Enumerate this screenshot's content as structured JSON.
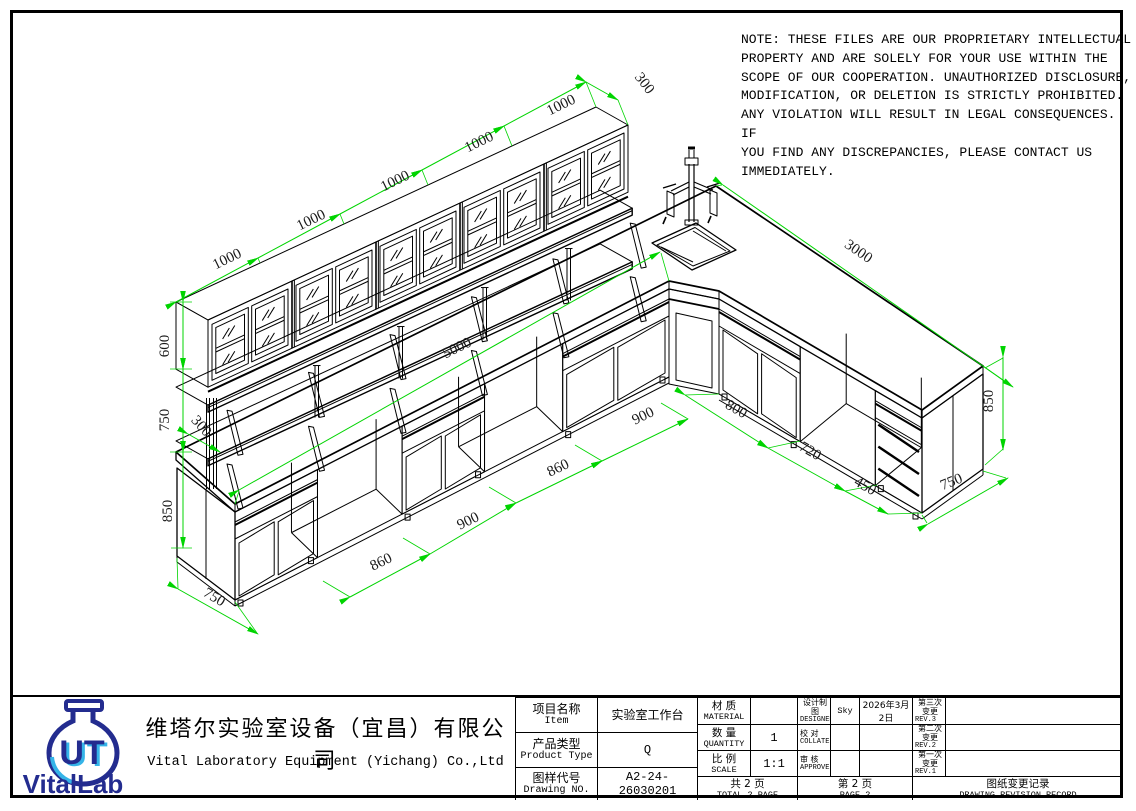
{
  "note": {
    "text": "NOTE: THESE FILES ARE OUR PROPRIETARY INTELLECTUAL\nPROPERTY AND ARE SOLELY FOR YOUR USE WITHIN THE\nSCOPE OF OUR COOPERATION. UNAUTHORIZED DISCLOSURE,\nMODIFICATION, OR DELETION IS STRICTLY PROHIBITED.\nANY VIOLATION WILL RESULT IN LEGAL CONSEQUENCES. IF\nYOU FIND ANY DISCREPANCIES, PLEASE CONTACT US\nIMMEDIATELY."
  },
  "drawing": {
    "dimension_color": "#00d400",
    "line_color": "#000000",
    "labels": [
      {
        "text": "1000",
        "x": 229,
        "y": 263,
        "r": -26
      },
      {
        "text": "1000",
        "x": 313,
        "y": 224,
        "r": -26
      },
      {
        "text": "1000",
        "x": 397,
        "y": 185,
        "r": -26
      },
      {
        "text": "1000",
        "x": 481,
        "y": 146,
        "r": -26
      },
      {
        "text": "1000",
        "x": 563,
        "y": 109,
        "r": -26
      },
      {
        "text": "300",
        "x": 641,
        "y": 86,
        "r": 52
      },
      {
        "text": "600",
        "x": 169,
        "y": 346,
        "r": -90
      },
      {
        "text": "750",
        "x": 169,
        "y": 420,
        "r": -90
      },
      {
        "text": "300",
        "x": 198,
        "y": 429,
        "r": 48
      },
      {
        "text": "850",
        "x": 172,
        "y": 511,
        "r": -90
      },
      {
        "text": "750",
        "x": 212,
        "y": 601,
        "r": 31
      },
      {
        "text": "5000",
        "x": 459,
        "y": 352,
        "r": -26
      },
      {
        "text": "860",
        "x": 383,
        "y": 566,
        "r": -26
      },
      {
        "text": "900",
        "x": 470,
        "y": 525,
        "r": -26
      },
      {
        "text": "860",
        "x": 560,
        "y": 472,
        "r": -26
      },
      {
        "text": "900",
        "x": 645,
        "y": 420,
        "r": -26
      },
      {
        "text": "800",
        "x": 734,
        "y": 413,
        "r": 30
      },
      {
        "text": "720",
        "x": 808,
        "y": 455,
        "r": 30
      },
      {
        "text": "450",
        "x": 863,
        "y": 490,
        "r": 30
      },
      {
        "text": "750",
        "x": 953,
        "y": 486,
        "r": -22
      },
      {
        "text": "3000",
        "x": 856,
        "y": 255,
        "r": 34
      },
      {
        "text": "850",
        "x": 993,
        "y": 401,
        "r": -90
      }
    ]
  },
  "title_block": {
    "logo": {
      "brand": "VitalLab",
      "navy": "#232c8f",
      "blue": "#35b4e8"
    },
    "company_cn": "维塔尔实验室设备（宜昌）有限公司",
    "company_en": "Vital Laboratory Equipment (Yichang) Co.,Ltd",
    "item": {
      "cn": "项目名称",
      "en": "Item",
      "value": "实验室工作台"
    },
    "product": {
      "cn": "产品类型",
      "en": "Product Type",
      "value": "Q"
    },
    "drawing_no": {
      "cn": "图样代号",
      "en": "Drawing NO.",
      "value": "A2-24-26030201"
    },
    "material": {
      "cn": "材  质",
      "en": "MATERIAL",
      "value": ""
    },
    "quantity": {
      "cn": "数  量",
      "en": "QUANTITY",
      "value": "1"
    },
    "scale": {
      "cn": "比  例",
      "en": "SCALE",
      "value": "1:1"
    },
    "designer": {
      "cn": "设计制图",
      "en": "DESIGNER",
      "value": "Sky",
      "date": "2026年3月2日"
    },
    "collate": {
      "cn": "校  对",
      "en": "COLLATE",
      "value": ""
    },
    "approve": {
      "cn": "审  核",
      "en": "APPROVE",
      "value": ""
    },
    "pages": {
      "total_cn": "共  2  页",
      "total_en": "TOTAL 2 PAGE",
      "page_cn": "第  2  页",
      "page_en": "PAGE 2"
    },
    "revision": {
      "title_cn": "图纸变更记录",
      "title_en": "DRAWING REVISION RECORD",
      "rows": [
        {
          "cn": "第三次变更",
          "en": "REV.3",
          "note": ""
        },
        {
          "cn": "第二次变更",
          "en": "REV.2",
          "note": ""
        },
        {
          "cn": "第一次变更",
          "en": "REV.1",
          "note": ""
        }
      ]
    }
  }
}
